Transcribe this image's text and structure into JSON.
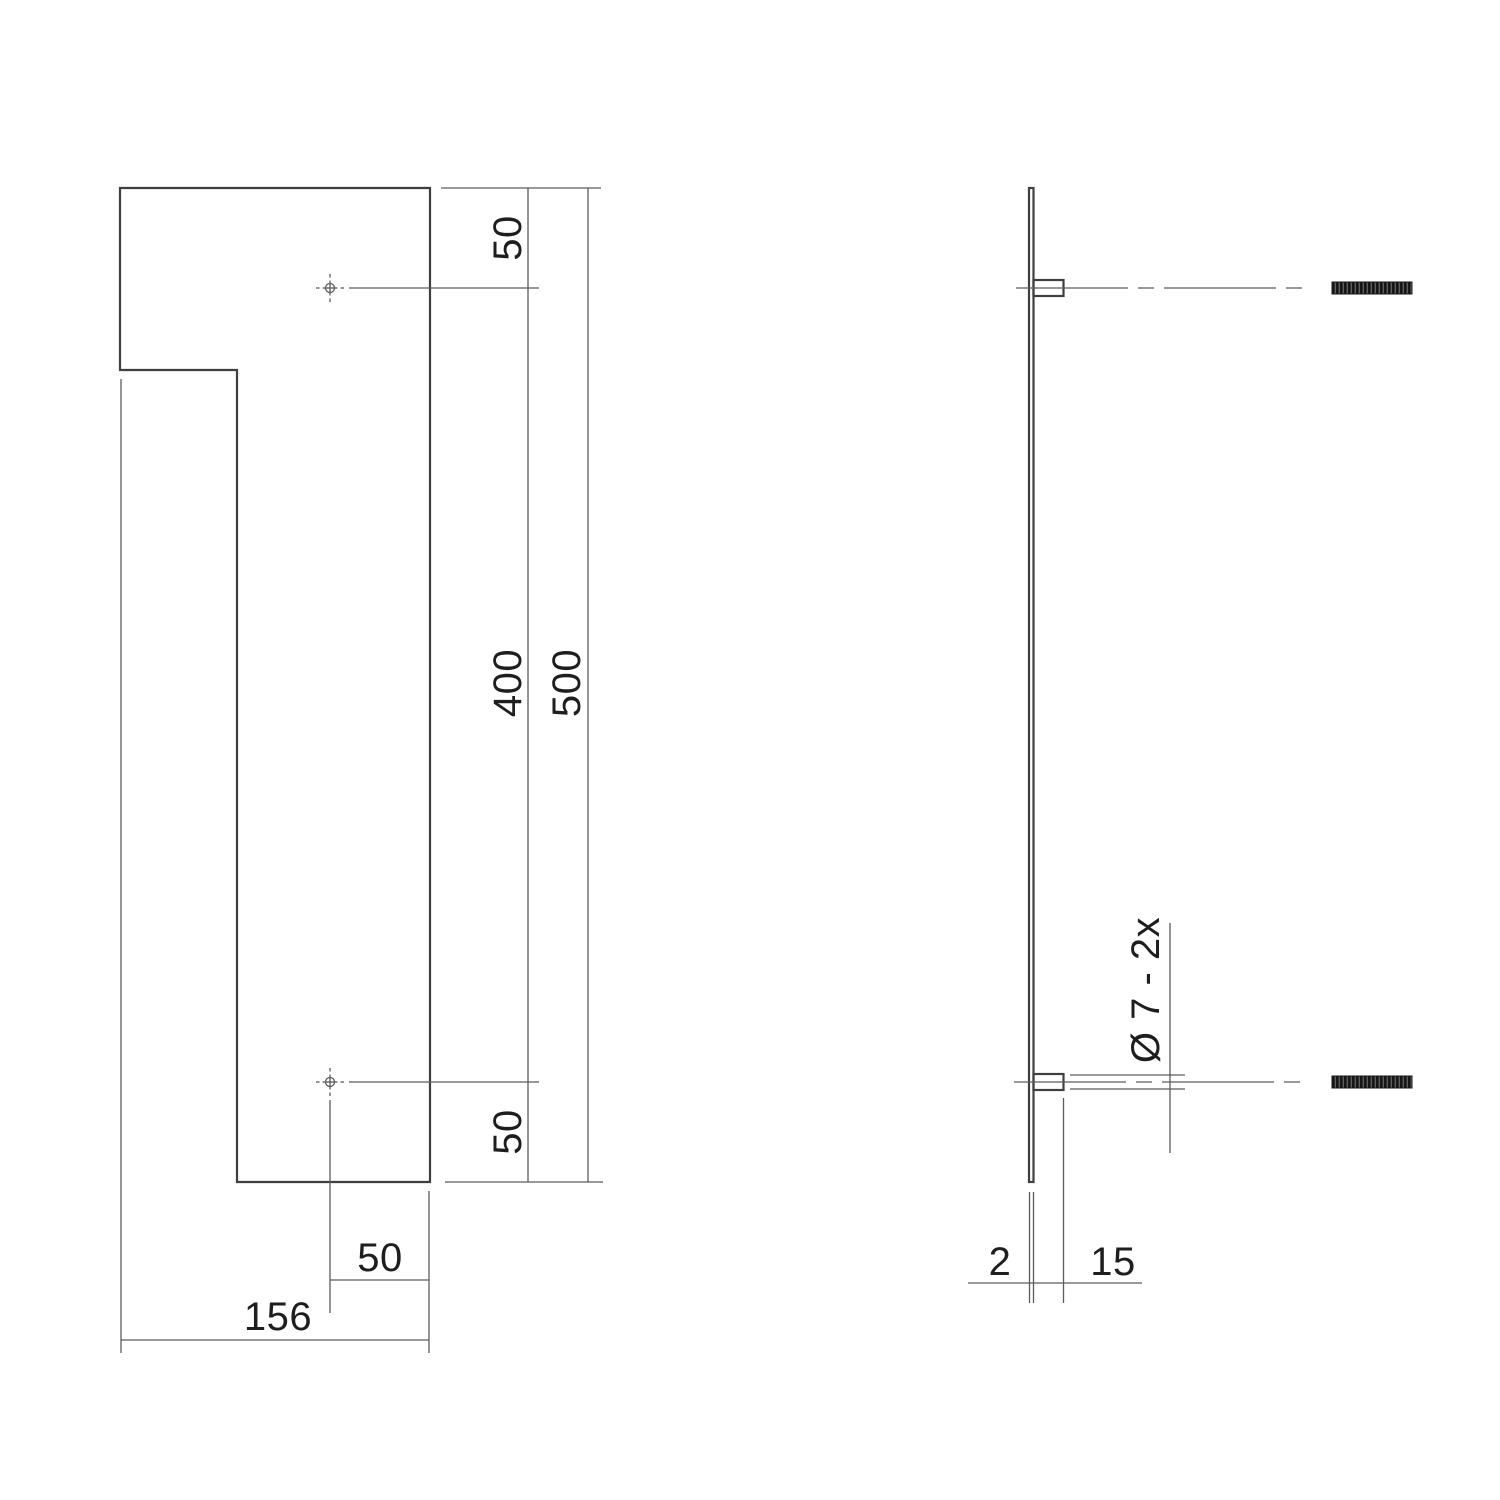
{
  "colors": {
    "background": "#ffffff",
    "object_line": "#3f3f3f",
    "dim_line": "#5c5c5c",
    "text": "#1e1e1e",
    "stud_fill": "#161616",
    "stud_ridge": "#6f6f6f"
  },
  "front_view": {
    "dimensions": {
      "top_edge_to_hole": "50",
      "hole_spacing": "400",
      "total_height": "500",
      "hole_to_bottom_edge": "50",
      "hole_to_right_edge": "50",
      "total_width": "156"
    }
  },
  "side_view": {
    "hole_note": "Ø 7 - 2x",
    "dimensions": {
      "plate_thickness": "2",
      "boss_length": "15"
    }
  }
}
